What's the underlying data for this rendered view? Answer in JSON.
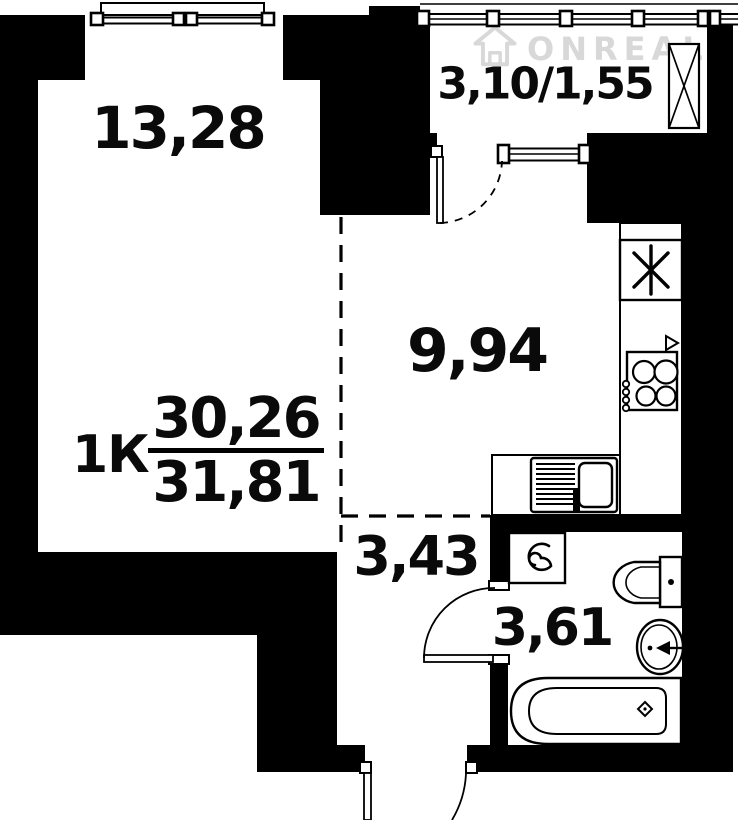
{
  "apartment": {
    "type_label": "1К",
    "area_fraction": {
      "numerator": "30,26",
      "denominator": "31,81"
    }
  },
  "rooms": {
    "living_room": {
      "area_label": "13,28"
    },
    "kitchen": {
      "area_label": "9,94"
    },
    "hallway": {
      "area_label": "3,43"
    },
    "bathroom": {
      "area_label": "3,61"
    },
    "balcony": {
      "area_label": "3,10/1,55"
    }
  },
  "watermark": {
    "brand_text": "ONREAL",
    "registered_mark": "®"
  },
  "colors": {
    "walls": "#000000",
    "background": "#ffffff",
    "labels": "#0a0a0a",
    "watermark": "#d8d8d8"
  },
  "icons": {
    "ventilation_shaft": "six-spoke-asterisk",
    "balcony_shaft": "crossed-box",
    "stove": "four-burner-hob",
    "kitchen_sink": "drainboard-and-bowl",
    "washing_machine": "spiral-drum",
    "toilet": "tank-and-bowl",
    "washbasin": "oval-basin-with-tap",
    "bathtub": "rounded-tub-with-drain",
    "watermark_logo": "house-outline"
  }
}
